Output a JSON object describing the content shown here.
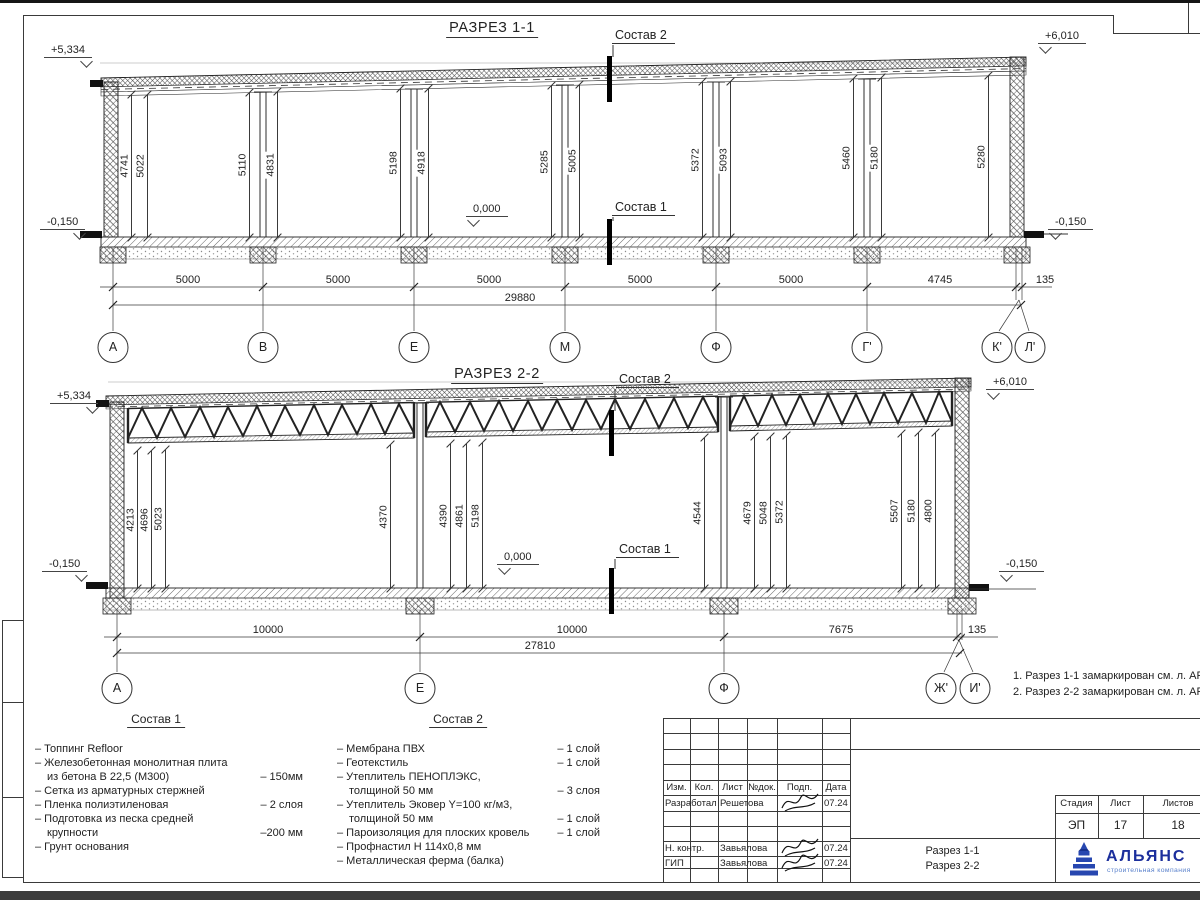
{
  "titles": {
    "s1": "РАЗРЕЗ 1-1",
    "s2": "РАЗРЕЗ 2-2"
  },
  "s1": {
    "total_dim": "29880",
    "elevs": [
      {
        "x": 44,
        "y": 44,
        "v": "+5,334",
        "cls": "ar"
      },
      {
        "x": 1038,
        "y": 30,
        "v": "+6,010",
        "cls": "al"
      },
      {
        "x": 40,
        "y": 216,
        "v": "-0,150",
        "cls": "ar"
      },
      {
        "x": 1048,
        "y": 216,
        "v": "-0,150",
        "cls": "al"
      },
      {
        "x": 466,
        "y": 203,
        "v": "0,000",
        "cls": "al"
      }
    ],
    "vdims": [
      {
        "x": 131,
        "y": 95,
        "h": 142,
        "v": "4741"
      },
      {
        "x": 147,
        "y": 95,
        "h": 142,
        "v": "5022"
      },
      {
        "x": 249,
        "y": 93,
        "h": 144,
        "v": "5110"
      },
      {
        "x": 277,
        "y": 92,
        "h": 145,
        "v": "4831"
      },
      {
        "x": 400,
        "y": 89,
        "h": 148,
        "v": "5198"
      },
      {
        "x": 428,
        "y": 89,
        "h": 148,
        "v": "4918"
      },
      {
        "x": 551,
        "y": 86,
        "h": 151,
        "v": "5285"
      },
      {
        "x": 579,
        "y": 85,
        "h": 152,
        "v": "5005"
      },
      {
        "x": 702,
        "y": 82,
        "h": 155,
        "v": "5372"
      },
      {
        "x": 730,
        "y": 82,
        "h": 155,
        "v": "5093"
      },
      {
        "x": 853,
        "y": 79,
        "h": 158,
        "v": "5460"
      },
      {
        "x": 881,
        "y": 78,
        "h": 159,
        "v": "5180"
      },
      {
        "x": 988,
        "y": 76,
        "h": 161,
        "v": "5280"
      }
    ],
    "hdims": [
      {
        "x": 188,
        "y": 274,
        "v": "5000"
      },
      {
        "x": 338,
        "y": 274,
        "v": "5000"
      },
      {
        "x": 489,
        "y": 274,
        "v": "5000"
      },
      {
        "x": 640,
        "y": 274,
        "v": "5000"
      },
      {
        "x": 791,
        "y": 274,
        "v": "5000"
      },
      {
        "x": 940,
        "y": 274,
        "v": "4745"
      },
      {
        "x": 1045,
        "y": 274,
        "v": "135"
      }
    ],
    "axes": [
      {
        "x": 113,
        "y": 332,
        "label": "А"
      },
      {
        "x": 263,
        "y": 332,
        "label": "В"
      },
      {
        "x": 414,
        "y": 332,
        "label": "Е"
      },
      {
        "x": 565,
        "y": 332,
        "label": "М"
      },
      {
        "x": 716,
        "y": 332,
        "label": "Ф"
      },
      {
        "x": 867,
        "y": 332,
        "label": "Г'"
      },
      {
        "x": 997,
        "y": 332,
        "label": "К'"
      },
      {
        "x": 1030,
        "y": 332,
        "label": "Л'"
      }
    ],
    "cut_labels": [
      {
        "x": 612,
        "y": 28,
        "v": "Состав 2"
      },
      {
        "x": 612,
        "y": 200,
        "v": "Состав 1"
      }
    ]
  },
  "s2": {
    "total_dim": "27810",
    "elevs": [
      {
        "x": 50,
        "y": 390,
        "v": "+5,334",
        "cls": "ar"
      },
      {
        "x": 986,
        "y": 376,
        "v": "+6,010",
        "cls": "al"
      },
      {
        "x": 42,
        "y": 558,
        "v": "-0,150",
        "cls": "ar"
      },
      {
        "x": 999,
        "y": 558,
        "v": "-0,150",
        "cls": "al"
      },
      {
        "x": 497,
        "y": 551,
        "v": "0,000",
        "cls": "al"
      }
    ],
    "vdims": [
      {
        "x": 137,
        "y": 451,
        "h": 137,
        "v": "4213"
      },
      {
        "x": 151,
        "y": 451,
        "h": 137,
        "v": "4696"
      },
      {
        "x": 165,
        "y": 450,
        "h": 138,
        "v": "5023"
      },
      {
        "x": 390,
        "y": 445,
        "h": 143,
        "v": "4370"
      },
      {
        "x": 450,
        "y": 444,
        "h": 144,
        "v": "4390"
      },
      {
        "x": 466,
        "y": 444,
        "h": 144,
        "v": "4861"
      },
      {
        "x": 482,
        "y": 443,
        "h": 145,
        "v": "5198"
      },
      {
        "x": 704,
        "y": 438,
        "h": 150,
        "v": "4544"
      },
      {
        "x": 754,
        "y": 437,
        "h": 151,
        "v": "4679"
      },
      {
        "x": 770,
        "y": 437,
        "h": 151,
        "v": "5048"
      },
      {
        "x": 786,
        "y": 436,
        "h": 152,
        "v": "5372"
      },
      {
        "x": 901,
        "y": 434,
        "h": 154,
        "v": "5507"
      },
      {
        "x": 918,
        "y": 433,
        "h": 155,
        "v": "5180"
      },
      {
        "x": 935,
        "y": 433,
        "h": 155,
        "v": "4800"
      }
    ],
    "hdims": [
      {
        "x": 268,
        "y": 624,
        "v": "10000"
      },
      {
        "x": 572,
        "y": 624,
        "v": "10000"
      },
      {
        "x": 841,
        "y": 624,
        "v": "7675"
      },
      {
        "x": 977,
        "y": 624,
        "v": "135"
      }
    ],
    "axes": [
      {
        "x": 117,
        "y": 673,
        "label": "А"
      },
      {
        "x": 420,
        "y": 673,
        "label": "Е"
      },
      {
        "x": 724,
        "y": 673,
        "label": "Ф"
      },
      {
        "x": 941,
        "y": 673,
        "label": "Ж'"
      },
      {
        "x": 975,
        "y": 673,
        "label": "И'"
      }
    ],
    "cut_labels": [
      {
        "x": 616,
        "y": 372,
        "v": "Состав 2"
      },
      {
        "x": 616,
        "y": 542,
        "v": "Состав 1"
      }
    ]
  },
  "notes": [
    {
      "v": "1. Разрез 1-1 замаркирован см. л. АР-15"
    },
    {
      "v": "2. Разрез 2-2 замаркирован см. л. АР-15"
    }
  ],
  "sostav1": {
    "title": "Состав 1",
    "items": [
      {
        "t": "– Топпинг Refloor",
        "t2": "",
        "v": ""
      },
      {
        "t": "– Железобетонная  монолитная плита",
        "t2": "из бетона В 22,5 (М300)",
        "v": "– 150мм"
      },
      {
        "t": "– Сетка из арматурных стержней",
        "t2": "",
        "v": ""
      },
      {
        "t": "– Пленка полиэтиленовая",
        "t2": "",
        "v": "–  2 слоя"
      },
      {
        "t": "– Подготовка из песка средней",
        "t2": "крупности",
        "v": "–200 мм"
      },
      {
        "t": "– Грунт основания",
        "t2": "",
        "v": ""
      }
    ]
  },
  "sostav2": {
    "title": "Состав 2",
    "items": [
      {
        "t": "– Мембрана ПВХ",
        "t2": "",
        "v": "– 1 слой"
      },
      {
        "t": "– Геотекстиль",
        "t2": "",
        "v": "– 1 слой"
      },
      {
        "t": "– Утеплитель ПЕНОПЛЭКС,",
        "t2": "толщиной 50 мм",
        "v": "– 3 слоя"
      },
      {
        "t": "– Утеплитель Эковер Y=100 кг/м3,",
        "t2": "толщиной 50 мм",
        "v": "– 1 слой"
      },
      {
        "t": "– Пароизоляция для плоских кровель",
        "t2": "",
        "v": "– 1 слой"
      },
      {
        "t": "– Профнастил Н 114х0,8 мм",
        "t2": "",
        "v": ""
      },
      {
        "t": "– Металлическая ферма (балка)",
        "t2": "",
        "v": ""
      }
    ]
  },
  "titleblock": {
    "rev_headers": [
      {
        "x": 663,
        "w": 27,
        "label": "Изм."
      },
      {
        "x": 690,
        "w": 28,
        "label": "Кол."
      },
      {
        "x": 718,
        "w": 29,
        "label": "Лист"
      },
      {
        "x": 747,
        "w": 30,
        "label": "№док."
      },
      {
        "x": 777,
        "w": 45,
        "label": "Подп."
      },
      {
        "x": 822,
        "w": 28,
        "label": "Дата"
      }
    ],
    "rows": [
      {
        "y": 797,
        "role": "Разработал",
        "name": "Решетова",
        "date": "07.24"
      },
      {
        "y": 842,
        "role": "Н. контр.",
        "name": "Завьялова",
        "date": "07.24"
      },
      {
        "y": 857,
        "role": "ГИП",
        "name": "Завьялова",
        "date": "07.24"
      }
    ],
    "stage_headers": [
      {
        "x": 1055,
        "w": 43,
        "label": "Стадия"
      },
      {
        "x": 1098,
        "w": 45,
        "label": "Лист"
      },
      {
        "x": 1143,
        "w": 70,
        "label": "Листов"
      }
    ],
    "stage_values": [
      {
        "x": 1055,
        "w": 43,
        "v": "ЭП"
      },
      {
        "x": 1098,
        "w": 45,
        "v": "17"
      },
      {
        "x": 1143,
        "w": 70,
        "v": "18"
      }
    ],
    "doc_lines": [
      {
        "y": 845,
        "v": "Разрез 1-1"
      },
      {
        "y": 860,
        "v": "Разрез 2-2"
      }
    ],
    "logo": {
      "name": "АЛЬЯНС",
      "sub": "строительная компания"
    }
  }
}
